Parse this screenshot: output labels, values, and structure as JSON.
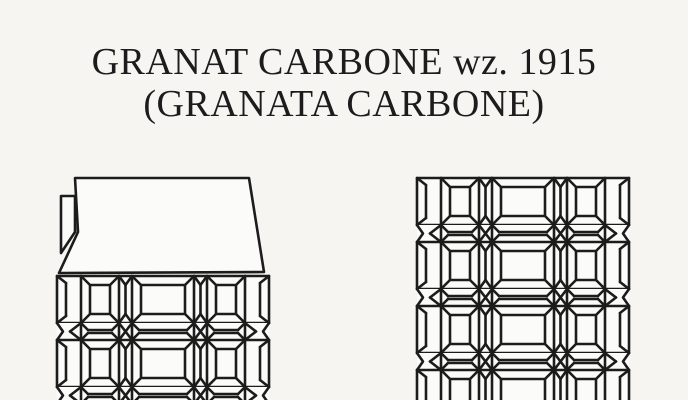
{
  "page": {
    "background": "#f6f5f2",
    "ink": "#1c1c1c",
    "paper_fill": "#fbfbf9"
  },
  "title": {
    "line1": "GRANAT CARBONE wz. 1915",
    "line2": "(GRANATA CARBONE)"
  }
}
